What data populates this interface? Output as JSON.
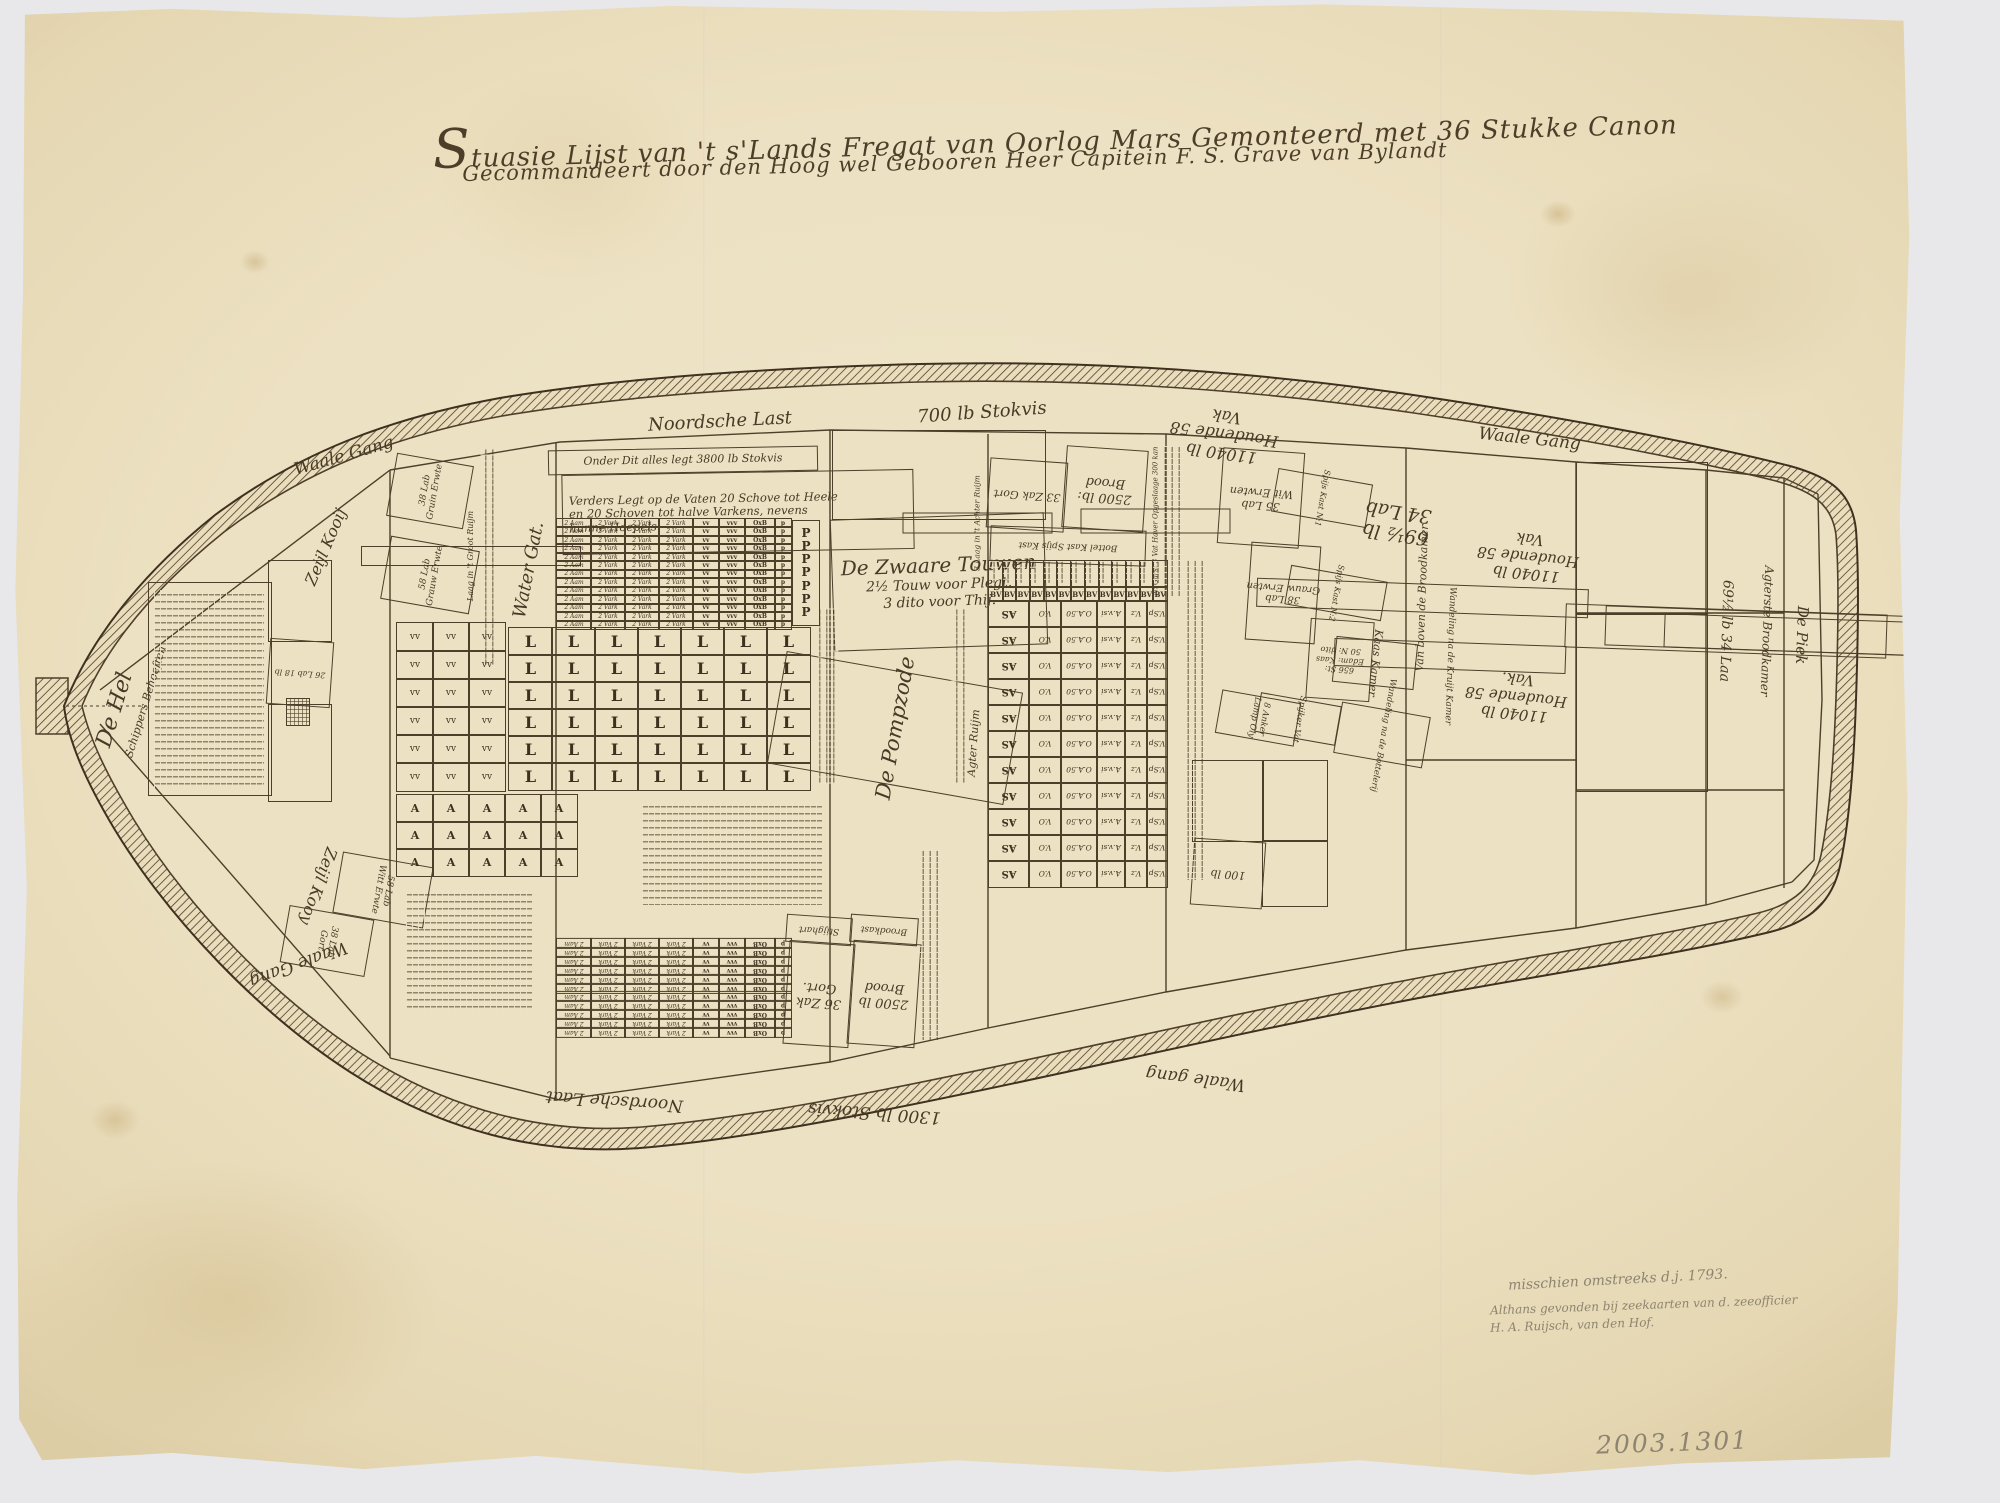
{
  "document": {
    "title_line1": "Stuasie Lijst van 't s'Lands Fregat van Oorlog Mars Gemonteerd met 36 Stukke Canon",
    "title_line2": "Gecommandeert door den Hoog wel Gebooren Heer Capitein F. S. Grave van Bylandt",
    "accession_number": "2003.1301",
    "pencil_notes": {
      "line1": "misschien omstreeks d.j. 1793.",
      "line2": "Althans gevonden bij zeekaarten van d. zeeofficier",
      "line3": "H. A. Ruijsch, van den Hof."
    }
  },
  "colors": {
    "paper": "#ece1c2",
    "ink": "#4d3f2a",
    "pencil": "#8d8471",
    "background": "#e8e8ea"
  },
  "plan": {
    "labels": [
      {
        "id": "gangway-top-left",
        "text": "Waale Gang",
        "x": 276,
        "y": 436,
        "w": 136,
        "h": 42,
        "rot": -16,
        "size": 17
      },
      {
        "id": "gangway-top-right",
        "text": "Waale Gang",
        "x": 1452,
        "y": 420,
        "w": 155,
        "h": 40,
        "rot": 6,
        "size": 17
      },
      {
        "id": "gangway-bottom-right",
        "text": "Waale gang",
        "x": 1118,
        "y": 1056,
        "w": 155,
        "h": 45,
        "rot": 187,
        "size": 17
      },
      {
        "id": "gangway-bottom-left",
        "text": "Waale Gang",
        "x": 228,
        "y": 924,
        "w": 140,
        "h": 78,
        "rot": 160,
        "size": 17
      },
      {
        "id": "noordsche-last-top",
        "text": "Noordsche Last",
        "x": 610,
        "y": 404,
        "w": 220,
        "h": 36,
        "rot": -3,
        "size": 18
      },
      {
        "id": "stokvis-700",
        "text": "700 lb Stokvis",
        "x": 872,
        "y": 395,
        "w": 220,
        "h": 36,
        "rot": -4,
        "size": 18
      },
      {
        "id": "noordsche-last-bottom",
        "text": "Noordsche Laat",
        "x": 512,
        "y": 1080,
        "w": 205,
        "h": 40,
        "rot": 184,
        "size": 17
      },
      {
        "id": "stokvis-1300",
        "text": "1300 lb Stokvis",
        "x": 772,
        "y": 1092,
        "w": 205,
        "h": 40,
        "rot": 184,
        "size": 17
      },
      {
        "id": "de-hel",
        "text": "De Hel",
        "x": 90,
        "y": 646,
        "w": 50,
        "h": 128,
        "rot": -73,
        "size": 22
      },
      {
        "id": "schippers-behoeften",
        "text": "Schippers Behoeften",
        "x": 124,
        "y": 620,
        "w": 44,
        "h": 164,
        "rot": -73,
        "size": 11
      },
      {
        "id": "zeijl-kooij-top",
        "text": "Zeijl Kooij",
        "x": 290,
        "y": 496,
        "w": 72,
        "h": 102,
        "rot": -67,
        "size": 16
      },
      {
        "id": "zeijl-kooij-bottom",
        "text": "Zeijl Kooy",
        "x": 282,
        "y": 833,
        "w": 72,
        "h": 106,
        "rot": 110,
        "size": 16
      },
      {
        "id": "water-gat",
        "text": "Water Gat.",
        "x": 504,
        "y": 466,
        "w": 50,
        "h": 208,
        "rot": -79,
        "size": 18
      },
      {
        "id": "groot-ruijm-strip",
        "text": "Laag in 't Groot Ruijm",
        "x": 461,
        "y": 446,
        "w": 18,
        "h": 218,
        "rot": -90,
        "size": 8,
        "box": true
      },
      {
        "id": "stokvis-note",
        "text": "Onder Dit alles legt 3800 lb Stokvis",
        "x": 548,
        "y": 448,
        "w": 268,
        "h": 23,
        "rot": -1,
        "size": 11,
        "box": true
      },
      {
        "id": "vaten-note",
        "lines": [
          "Verders Legt op de Vaten 20 Schove tot Heele",
          "en 20 Schoven tot halve Varkens, nevens",
          "hunne Hoepels. —"
        ],
        "x": 562,
        "y": 472,
        "w": 344,
        "h": 78,
        "rot": -1,
        "size": 11.5,
        "box": true,
        "align": "left"
      },
      {
        "id": "zwaare-touwen",
        "lines": [
          "De Zwaare Touwen",
          "2½ Touw voor Plegt.",
          "3 dito voor Thij."
        ],
        "x": 832,
        "y": 516,
        "w": 212,
        "h": 130,
        "rot": -2,
        "size": 14,
        "big_first": 20,
        "box": true
      },
      {
        "id": "pompzode",
        "text": "De Pompzode",
        "x": 838,
        "y": 608,
        "w": 112,
        "h": 238,
        "rot": -80,
        "size": 21,
        "box": true
      },
      {
        "id": "achter-ruijm-strip",
        "text": "3 Laag in 't Achter Ruijm",
        "x": 967,
        "y": 448,
        "w": 19,
        "h": 148,
        "rot": -90,
        "size": 7.5,
        "box": true
      },
      {
        "id": "agter-ruijm",
        "text": "Agter Ruijm",
        "x": 960,
        "y": 640,
        "w": 28,
        "h": 206,
        "rot": -86,
        "size": 11
      },
      {
        "id": "gort-33",
        "text": "33 Zak Gort",
        "x": 988,
        "y": 460,
        "w": 76,
        "h": 68,
        "rot": 184,
        "size": 11,
        "box": true
      },
      {
        "id": "brood-2500-top",
        "lines": [
          "2500 lb:",
          "Brood"
        ],
        "x": 1064,
        "y": 448,
        "w": 80,
        "h": 80,
        "rot": 184,
        "size": 13,
        "box": true
      },
      {
        "id": "spijskast-bottelkast",
        "text": "Bottel Kast      Spijs Kast",
        "x": 990,
        "y": 528,
        "w": 154,
        "h": 34,
        "rot": 182,
        "size": 9,
        "box": true
      },
      {
        "id": "garst-haver-strip",
        "text": "N: Garst 3 Vat Haver Opgeslaage 300 kan",
        "x": 1143,
        "y": 446,
        "w": 23,
        "h": 148,
        "rot": -90,
        "size": 7,
        "box": true
      },
      {
        "id": "stijghart",
        "text": "Stijghart",
        "x": 786,
        "y": 916,
        "w": 64,
        "h": 26,
        "rot": 184,
        "size": 9,
        "box": true
      },
      {
        "id": "broodkast",
        "text": "Broodkast",
        "x": 850,
        "y": 916,
        "w": 66,
        "h": 26,
        "rot": 184,
        "size": 9,
        "box": true
      },
      {
        "id": "gort-36",
        "lines": [
          "36 Zak",
          "Gort."
        ],
        "x": 786,
        "y": 942,
        "w": 64,
        "h": 102,
        "rot": 184,
        "size": 13,
        "box": true
      },
      {
        "id": "brood-2500-bottom",
        "lines": [
          "2500 lb",
          "Brood"
        ],
        "x": 850,
        "y": 942,
        "w": 66,
        "h": 102,
        "rot": 184,
        "size": 13,
        "box": true
      },
      {
        "id": "wit-erwten-35",
        "lines": [
          "35 Lab",
          "Wit Erwten"
        ],
        "x": 1220,
        "y": 450,
        "w": 80,
        "h": 94,
        "rot": 184,
        "size": 11,
        "box": true
      },
      {
        "id": "spijs-kast-1",
        "text": "Spijs Kast N:1",
        "x": 1300,
        "y": 450,
        "w": 42,
        "h": 94,
        "rot": 100,
        "size": 8,
        "box": true
      },
      {
        "id": "grauw-erwten-38",
        "lines": [
          "38 Lab",
          "Grauw Erwten"
        ],
        "x": 1248,
        "y": 544,
        "w": 68,
        "h": 96,
        "rot": 184,
        "size": 10,
        "box": true
      },
      {
        "id": "spijs-kast-2",
        "text": "Spijs Kast N:2",
        "x": 1316,
        "y": 544,
        "w": 38,
        "h": 96,
        "rot": 100,
        "size": 8,
        "box": true
      },
      {
        "id": "edammer-kaas",
        "lines": [
          "656 St:",
          "Edam: Kaas",
          "50 N: dito"
        ],
        "x": 1308,
        "y": 620,
        "w": 62,
        "h": 78,
        "rot": 184,
        "size": 8,
        "box": true
      },
      {
        "id": "kaas-kamer",
        "text": "Kaas Kamer",
        "x": 1352,
        "y": 622,
        "w": 44,
        "h": 80,
        "rot": 96,
        "size": 11,
        "box": true
      },
      {
        "id": "wandeling-bottelerij",
        "text": "Wandeling na de Bottelerij",
        "x": 1356,
        "y": 690,
        "w": 50,
        "h": 88,
        "rot": 100,
        "size": 8.5,
        "box": true
      },
      {
        "id": "lamp-oly",
        "lines": [
          "8 Anker",
          "Lamp Oly"
        ],
        "x": 1236,
        "y": 678,
        "w": 42,
        "h": 78,
        "rot": 100,
        "size": 8.5,
        "box": true
      },
      {
        "id": "spijker-vat",
        "text": "Spijker Vat",
        "x": 1278,
        "y": 678,
        "w": 38,
        "h": 80,
        "rot": 100,
        "size": 8.5,
        "box": true
      },
      {
        "id": "vak-11040-a",
        "lines": [
          "11040 lb",
          "Houdende 58",
          "Vak"
        ],
        "x": 1168,
        "y": 378,
        "w": 112,
        "h": 112,
        "rot": 188,
        "size": 16
      },
      {
        "id": "lab-69half",
        "lines": [
          "69½ lb",
          "34 Lab"
        ],
        "x": 1338,
        "y": 466,
        "w": 118,
        "h": 112,
        "rot": 188,
        "size": 19
      },
      {
        "id": "vak-11040-b",
        "lines": [
          "11040 lb",
          "Houdende 58",
          "Vak"
        ],
        "x": 1478,
        "y": 490,
        "w": 100,
        "h": 132,
        "rot": 186,
        "size": 15
      },
      {
        "id": "vak-11040-c",
        "lines": [
          "11040 lb",
          "Houdende 58",
          "Vak."
        ],
        "x": 1466,
        "y": 624,
        "w": 100,
        "h": 144,
        "rot": 186,
        "size": 15
      },
      {
        "id": "boven-broodkamer",
        "text": "Van boven de Broodkamer",
        "x": 1408,
        "y": 432,
        "w": 27,
        "h": 330,
        "rot": -88,
        "size": 11,
        "box": true
      },
      {
        "id": "wandeling-kruijt-kamer",
        "text": "Wandeling na de Kruijt Kamer",
        "x": 1436,
        "y": 540,
        "w": 26,
        "h": 230,
        "rot": 92,
        "size": 9,
        "box": true
      },
      {
        "id": "laa-69half",
        "text": "69½ lb 34 Laa",
        "x": 1704,
        "y": 470,
        "w": 42,
        "h": 320,
        "rot": 92,
        "size": 14,
        "box": true
      },
      {
        "id": "agterste-broodkamer",
        "text": "Agterste Broodkamer",
        "x": 1746,
        "y": 470,
        "w": 38,
        "h": 320,
        "rot": 92,
        "size": 12,
        "box": true
      },
      {
        "id": "de-piek",
        "text": "De Piek",
        "x": 1784,
        "y": 498,
        "w": 32,
        "h": 272,
        "rot": 92,
        "size": 15,
        "box": true
      },
      {
        "id": "gruin-erwte-38",
        "lines": [
          "38 Lab",
          "Gruin Erwte"
        ],
        "x": 398,
        "y": 452,
        "w": 62,
        "h": 76,
        "rot": -80,
        "size": 9,
        "box": true
      },
      {
        "id": "grauw-erwte-58",
        "lines": [
          "58 Lab",
          "Grauw Erwte"
        ],
        "x": 398,
        "y": 530,
        "w": 62,
        "h": 88,
        "rot": -80,
        "size": 9,
        "box": true
      },
      {
        "id": "witt-erwte-58",
        "lines": [
          "58 Lab",
          "Witt Erwte"
        ],
        "x": 352,
        "y": 844,
        "w": 60,
        "h": 90,
        "rot": 100,
        "size": 9,
        "box": true
      },
      {
        "id": "gort-38",
        "lines": [
          "38 Lab",
          "Gort"
        ],
        "x": 298,
        "y": 898,
        "w": 56,
        "h": 84,
        "rot": 100,
        "size": 9,
        "box": true
      },
      {
        "id": "lab-26",
        "text": "26 Lab 18 lb",
        "x": 268,
        "y": 640,
        "w": 62,
        "h": 64,
        "rot": 184,
        "size": 8,
        "box": true
      },
      {
        "id": "kast-100",
        "text": "100 lb",
        "x": 1192,
        "y": 840,
        "w": 70,
        "h": 65,
        "rot": 184,
        "size": 11,
        "box": true
      }
    ],
    "plain_boxes": [
      {
        "id": "touwen-upper-box",
        "x": 832,
        "y": 430,
        "w": 212,
        "h": 88
      },
      {
        "id": "stern-box-upper",
        "x": 1576,
        "y": 462,
        "w": 130,
        "h": 151
      },
      {
        "id": "stern-box-lower",
        "x": 1576,
        "y": 613,
        "w": 130,
        "h": 177
      },
      {
        "id": "inventory-box",
        "x": 148,
        "y": 582,
        "w": 122,
        "h": 212
      },
      {
        "id": "kooy-box-1",
        "x": 268,
        "y": 560,
        "w": 62,
        "h": 80
      },
      {
        "id": "kooy-box-2",
        "x": 268,
        "y": 704,
        "w": 62,
        "h": 96
      },
      {
        "id": "kast-box-1",
        "x": 1192,
        "y": 760,
        "w": 70,
        "h": 80
      },
      {
        "id": "kast-box-2",
        "x": 1262,
        "y": 760,
        "w": 64,
        "h": 80
      },
      {
        "id": "kast-box-3",
        "x": 1262,
        "y": 840,
        "w": 64,
        "h": 65
      }
    ],
    "scribbles": [
      {
        "id": "inventory-text",
        "x": 154,
        "y": 590,
        "w": 110,
        "h": 198,
        "vert": false
      },
      {
        "id": "bow-list-strip",
        "x": 480,
        "y": 448,
        "w": 17,
        "h": 216,
        "vert": true
      },
      {
        "id": "pomp-strip-left",
        "x": 818,
        "y": 608,
        "w": 20,
        "h": 175,
        "vert": true
      },
      {
        "id": "pomp-strip-right",
        "x": 950,
        "y": 608,
        "w": 18,
        "h": 175,
        "vert": true
      },
      {
        "id": "touw-berging-note",
        "x": 642,
        "y": 802,
        "w": 180,
        "h": 103,
        "vert": false
      },
      {
        "id": "ballast-note",
        "x": 406,
        "y": 890,
        "w": 126,
        "h": 122,
        "vert": false
      },
      {
        "id": "kooij-strip",
        "x": 1164,
        "y": 446,
        "w": 20,
        "h": 150,
        "vert": true
      },
      {
        "id": "bottelarij-strip",
        "x": 1185,
        "y": 560,
        "w": 22,
        "h": 320,
        "vert": true
      },
      {
        "id": "gang-strip",
        "x": 920,
        "y": 850,
        "w": 22,
        "h": 190,
        "vert": true
      }
    ],
    "grids": {
      "stores_table": {
        "x": 556,
        "y": 518,
        "h": 110,
        "rows": 13,
        "cols": [
          {
            "w": 34,
            "t": "2 Aam",
            "i": true
          },
          {
            "w": 34,
            "t": "2 Vark",
            "i": true
          },
          {
            "w": 34,
            "t": "2 Vark",
            "i": true
          },
          {
            "w": 34,
            "t": "2 Vark",
            "i": true
          },
          {
            "w": 26,
            "t": "vv"
          },
          {
            "w": 26,
            "t": "vvv"
          },
          {
            "w": 30,
            "t": "OxB"
          },
          {
            "w": 16,
            "t": "p"
          }
        ]
      },
      "stores_table_mirror": {
        "x": 556,
        "y": 938,
        "h": 98,
        "rows": 11,
        "mirror": true,
        "cols": [
          {
            "w": 34,
            "t": "2 Aam",
            "i": true
          },
          {
            "w": 34,
            "t": "2 Vark",
            "i": true
          },
          {
            "w": 34,
            "t": "2 Vark",
            "i": true
          },
          {
            "w": 34,
            "t": "2 Vark",
            "i": true
          },
          {
            "w": 26,
            "t": "vv"
          },
          {
            "w": 26,
            "t": "vvv"
          },
          {
            "w": 30,
            "t": "OxB"
          },
          {
            "w": 16,
            "t": "p"
          }
        ]
      },
      "p_column": {
        "x": 792,
        "y": 520,
        "w": 26,
        "h": 104,
        "letter": "P",
        "count": 7
      },
      "l_grid": {
        "x": 508,
        "y": 627,
        "cols": 7,
        "rows": 6,
        "cellw": 43,
        "cellh": 27,
        "letter": "L"
      },
      "v_block": {
        "x": 396,
        "y": 622,
        "cols": 3,
        "rows": 6,
        "cellw": 36,
        "cellh": 28,
        "letter": "vv"
      },
      "a_block": {
        "x": 396,
        "y": 794,
        "cols": 5,
        "rows": 3,
        "cellw": 36,
        "cellh": 27,
        "letter": "A"
      },
      "bv_table": {
        "x": 988,
        "y": 560,
        "w": 178,
        "header_h": 26,
        "bv_h": 14,
        "bv_count": 13,
        "bv_text": "BV",
        "body_rows": 11,
        "row_h": 26,
        "body_cols": [
          {
            "w": 40,
            "t": "AS",
            "b": true
          },
          {
            "w": 32,
            "t": "V.O"
          },
          {
            "w": 36,
            "t": "O.A.50"
          },
          {
            "w": 28,
            "t": "A.v.si"
          },
          {
            "w": 22,
            "t": "V.z"
          },
          {
            "w": 20,
            "t": "V.Sp"
          }
        ]
      }
    }
  }
}
